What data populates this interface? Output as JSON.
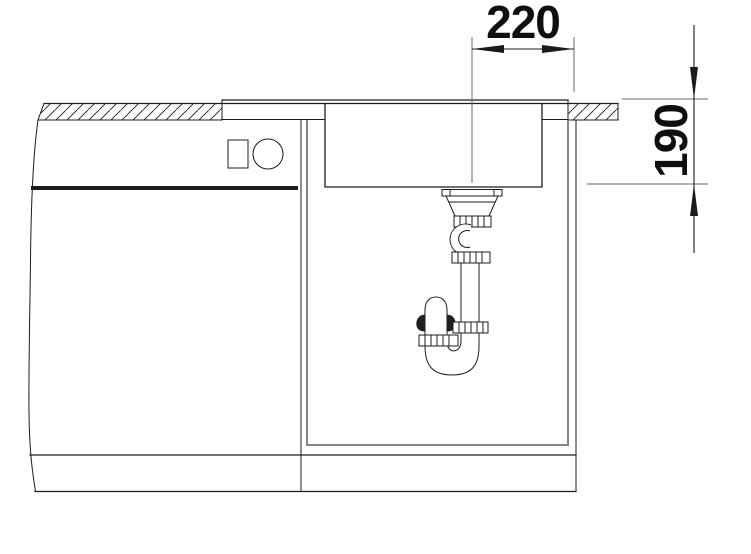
{
  "page": {
    "title": "Sink installation cross-section drawing",
    "type": "technical-section-diagram"
  },
  "annotations": {
    "horizontal_dimension": "220",
    "vertical_dimension": "190"
  },
  "colors": {
    "line": "#1c1c1c",
    "secondary_line": "#848484",
    "xline": "#6a6a6a",
    "text": "#0f0f0f",
    "background": "#ffffff"
  },
  "parts": {
    "worktop": "hatched worktop section cut",
    "sink_flange": "sink rim on worktop",
    "sink_bowl": "sink bowl section",
    "drain": "basket strainer drain",
    "siphon": "pipe siphon trap with union nuts",
    "cabinet": "base cabinet with drawer front and knobs",
    "plinth": "cabinet plinth band"
  }
}
